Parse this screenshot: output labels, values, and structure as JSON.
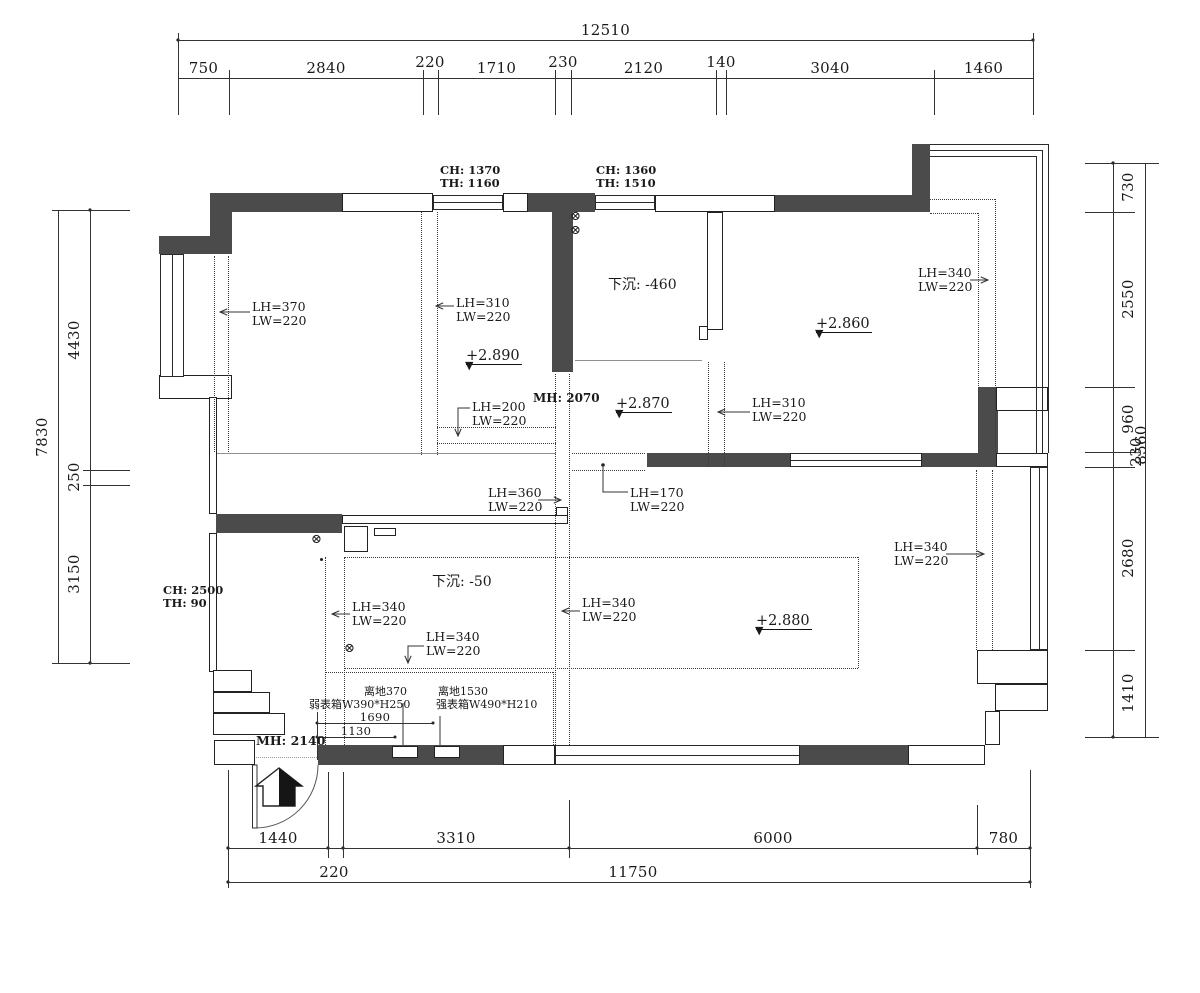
{
  "dims": {
    "top": {
      "total": "12510",
      "segs": [
        "750",
        "2840",
        "220",
        "1710",
        "230",
        "2120",
        "140",
        "3040",
        "1460"
      ]
    },
    "left": {
      "total": "7830",
      "segs": [
        "4430",
        "250",
        "3150"
      ]
    },
    "right": {
      "total": "8560",
      "segs": [
        "730",
        "2550",
        "960",
        "230",
        "2680",
        "1410"
      ]
    },
    "bottom": {
      "total": "11750",
      "segs": [
        "1440",
        "3310",
        "6000",
        "780"
      ],
      "offset": "220"
    },
    "interior": {
      "d1690": "1690",
      "d1130": "1130"
    }
  },
  "openings": {
    "top_window_left": {
      "ch": "CH: 1370",
      "th": "TH: 1160"
    },
    "top_window_right": {
      "ch": "CH: 1360",
      "th": "TH: 1510"
    },
    "side_door": {
      "ch": "CH: 2500",
      "th": "TH: 90"
    },
    "pass_height": "MH: 2070",
    "entry_height": "MH: 2140"
  },
  "levels": {
    "living": "+2.890",
    "hall": "+2.870",
    "bedroom": "+2.860",
    "master": "+2.880"
  },
  "sunken": {
    "bath": "下沉: -460",
    "kitchen": "下沉: -50"
  },
  "curtain_boxes": {
    "left_window": {
      "lh": "LH=370",
      "lw": "LW=220"
    },
    "left_mid": {
      "lh": "LH=310",
      "lw": "LW=220"
    },
    "mid_small": {
      "lh": "LH=200",
      "lw": "LW=220"
    },
    "hall_left": {
      "lh": "LH=360",
      "lw": "LW=220"
    },
    "hall_right": {
      "lh": "LH=170",
      "lw": "LW=220"
    },
    "bed_left": {
      "lh": "LH=310",
      "lw": "LW=220"
    },
    "bed_balcony": {
      "lh": "LH=340",
      "lw": "LW=220"
    },
    "master_right": {
      "lh": "LH=340",
      "lw": "LW=220"
    },
    "kitchen_left": {
      "lh": "LH=340",
      "lw": "LW=220"
    },
    "kitchen_mid": {
      "lh": "LH=340",
      "lw": "LW=220"
    },
    "master_left": {
      "lh": "LH=340",
      "lw": "LW=220"
    }
  },
  "meter_boxes": {
    "weak": {
      "height": "离地370",
      "label": "弱表箱W390*H250"
    },
    "strong": {
      "height": "离地1530",
      "label": "强表箱W490*H210"
    }
  },
  "symbols": {
    "outlet": "⊗",
    "level_marker": "▼"
  }
}
